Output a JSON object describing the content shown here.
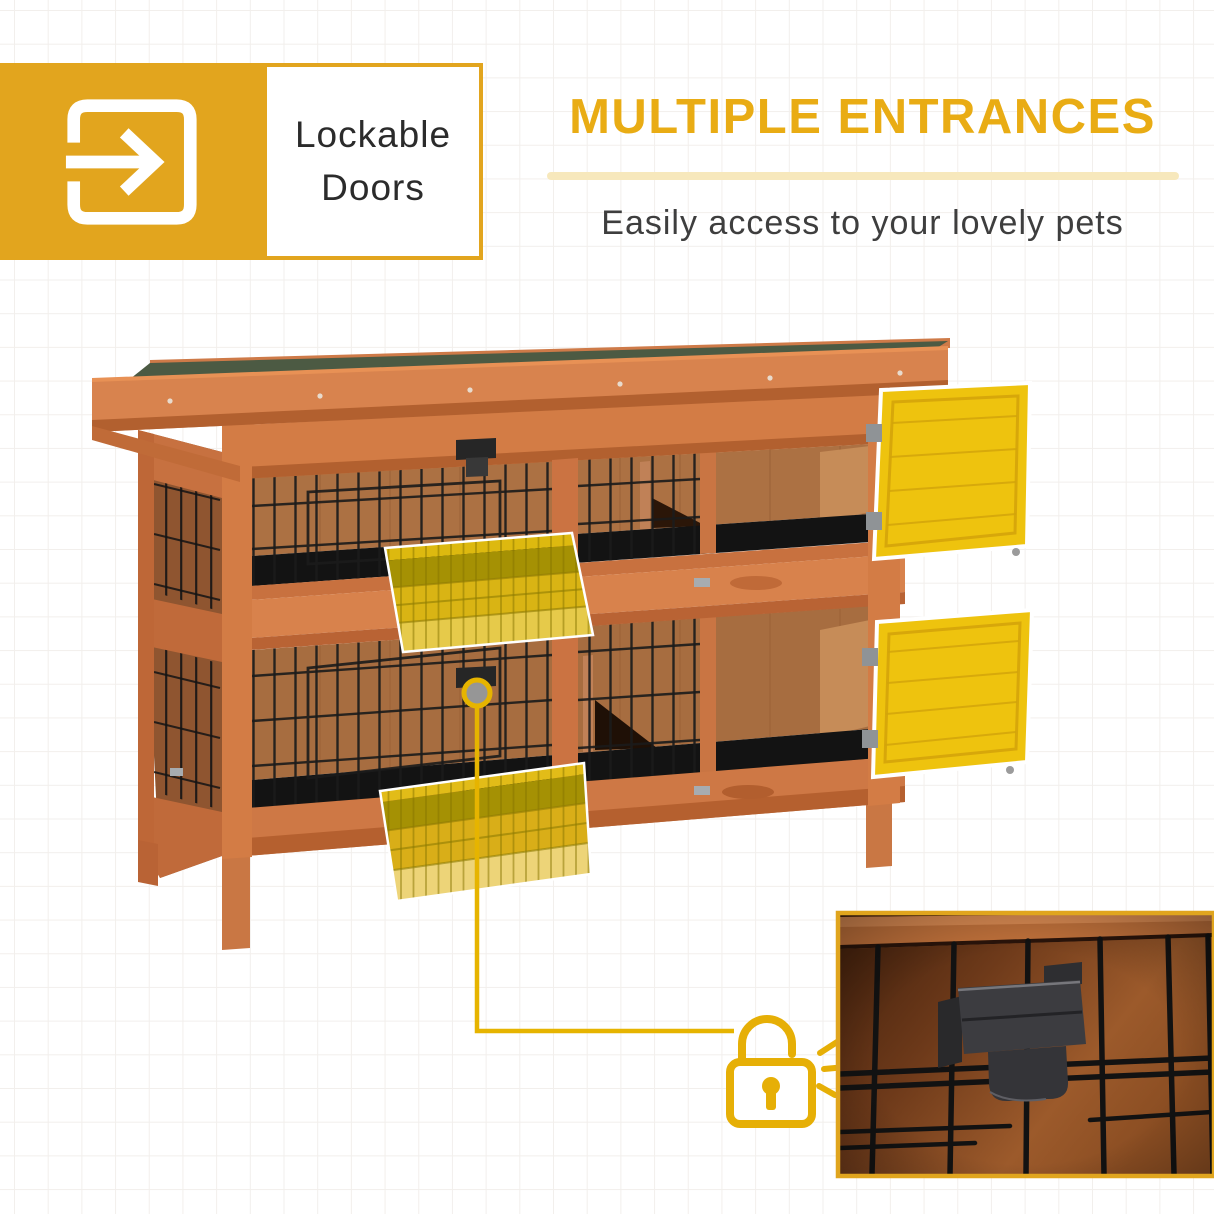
{
  "feature_badge": {
    "line1": "Lockable",
    "line2": "Doors"
  },
  "headline": {
    "title": "MULTIPLE ENTRANCES",
    "subtitle": "Easily access to your lovely pets"
  },
  "figure": {
    "alt": "Two-storey wooden rabbit hutch with black wire mesh fronts; two yellow-highlighted doors are shown open on the right, two yellow-highlighted pull-out cleaning trays are shown pulled out, and a callout line runs from a lock fastener to a padlock icon beside a close-up photo of the metal lock clip on the cage wire",
    "inset_alt": "Close-up of the metal locking clip on the black wire mesh"
  },
  "colors": {
    "brand_yellow": "#E2A51E",
    "headline_yellow": "#E9AC14",
    "underline_pale_yellow": "#F7E8BC",
    "badge_text": "#2b2b2b",
    "subtitle_text": "#3E3E3E",
    "door_highlight_yellow": "#EEC30E",
    "tray_highlight_yellow": "#D9B414",
    "tray_olive": "#A59104",
    "wood_orange": "#D37C45",
    "wood_dark": "#B2602F",
    "plywood_brown": "#AC7143",
    "roof_green": "#4C5A43",
    "mesh_black": "#1B1B1B",
    "padlock_yellow": "#E6AF06"
  }
}
